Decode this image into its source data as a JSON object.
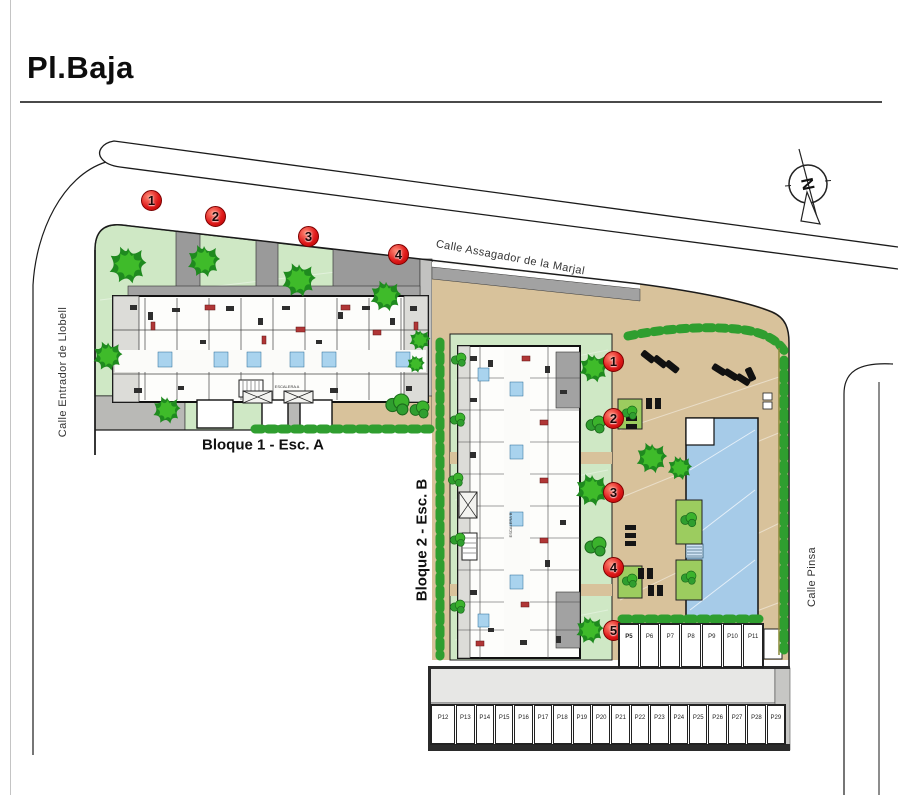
{
  "title": "Pl.Baja",
  "streets": {
    "top": "Calle Assagador de la Marjal",
    "left": "Calle Entrador de Llobell",
    "right": "Calle Pinsa"
  },
  "blocks": {
    "block1_label": "Bloque 1 - Esc. A",
    "block2_label": "Bloque 2 - Esc. B",
    "stair_a": "ESCALERA A",
    "stair_b": "ESCALERA B"
  },
  "markers": {
    "top": [
      "1",
      "2",
      "3",
      "4"
    ],
    "side": [
      "1",
      "2",
      "3",
      "4",
      "5"
    ]
  },
  "parking": {
    "row_side": [
      "P5",
      "P6",
      "P7",
      "P8",
      "P9",
      "P10",
      "P11"
    ],
    "row_bottom": [
      "P12",
      "P13",
      "P14",
      "P15",
      "P16",
      "P17",
      "P18",
      "P19",
      "P20",
      "P21",
      "P22",
      "P23",
      "P24",
      "P25",
      "P26",
      "P27",
      "P28",
      "P29"
    ]
  },
  "compass": {
    "label": "N"
  },
  "colors": {
    "marker_red": "#e01b1b",
    "garden_green": "#cfe8c5",
    "tree_green": "#2da12d",
    "terrace_tan": "#d8c29b",
    "pool_blue": "#a6cbe8",
    "building_gray": "#e9e9e7",
    "path_gray": "#9a9a9a"
  }
}
